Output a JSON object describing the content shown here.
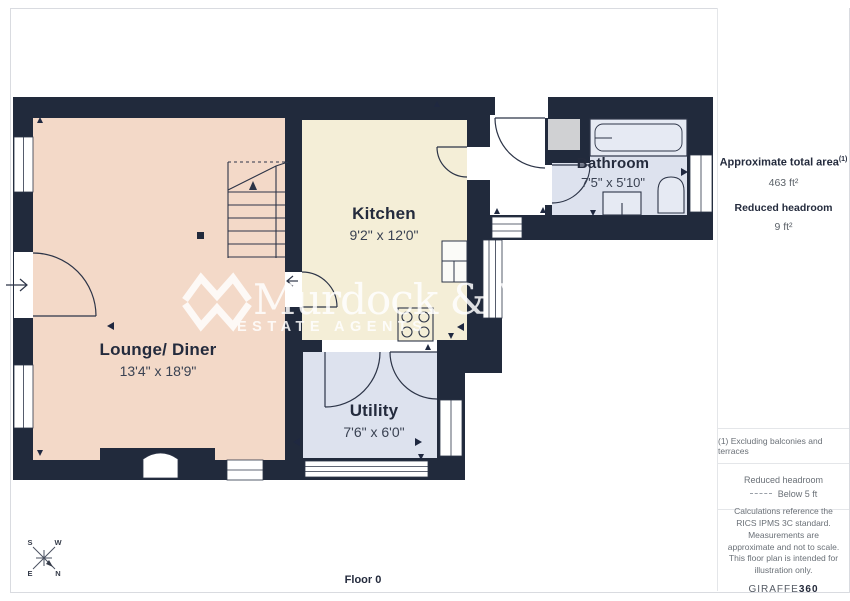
{
  "plan": {
    "floor_label": "Floor 0",
    "rooms": [
      {
        "id": "lounge",
        "name": "Lounge/ Diner",
        "dims": "13'4\" x 18'9\""
      },
      {
        "id": "kitchen",
        "name": "Kitchen",
        "dims": "9'2\" x 12'0\""
      },
      {
        "id": "bathroom",
        "name": "Bathroom",
        "dims": "7'5\" x 5'10\""
      },
      {
        "id": "utility",
        "name": "Utility",
        "dims": "7'6\" x 6'0\""
      }
    ],
    "compass": {
      "s": "S",
      "w": "W",
      "e": "E",
      "n": "N"
    },
    "watermark": {
      "name": "Murdock & Wasp",
      "tagline": "ESTATE AGENTS"
    },
    "colors": {
      "wall": "#212a3c",
      "lounge": "#f3d9c8",
      "kitchen": "#f4eed7",
      "wet_rooms": "#dde2ee",
      "hall": "#ffffff",
      "cupboard": "#d0d1d3"
    }
  },
  "sidebar": {
    "total_area_label": "Approximate total area",
    "total_area_sup": "(1)",
    "total_area_value": "463 ft²",
    "reduced_headroom_label": "Reduced headroom",
    "reduced_headroom_value": "9 ft²",
    "note": "(1) Excluding balconies and terraces",
    "legend_title": "Reduced headroom",
    "legend_item": "Below 5 ft",
    "disclaimer": "Calculations reference the RICS IPMS 3C standard. Measurements are approximate and not to scale. This floor plan is intended for illustration only.",
    "brand_name": "GIRAFFE",
    "brand_suffix": "360"
  }
}
